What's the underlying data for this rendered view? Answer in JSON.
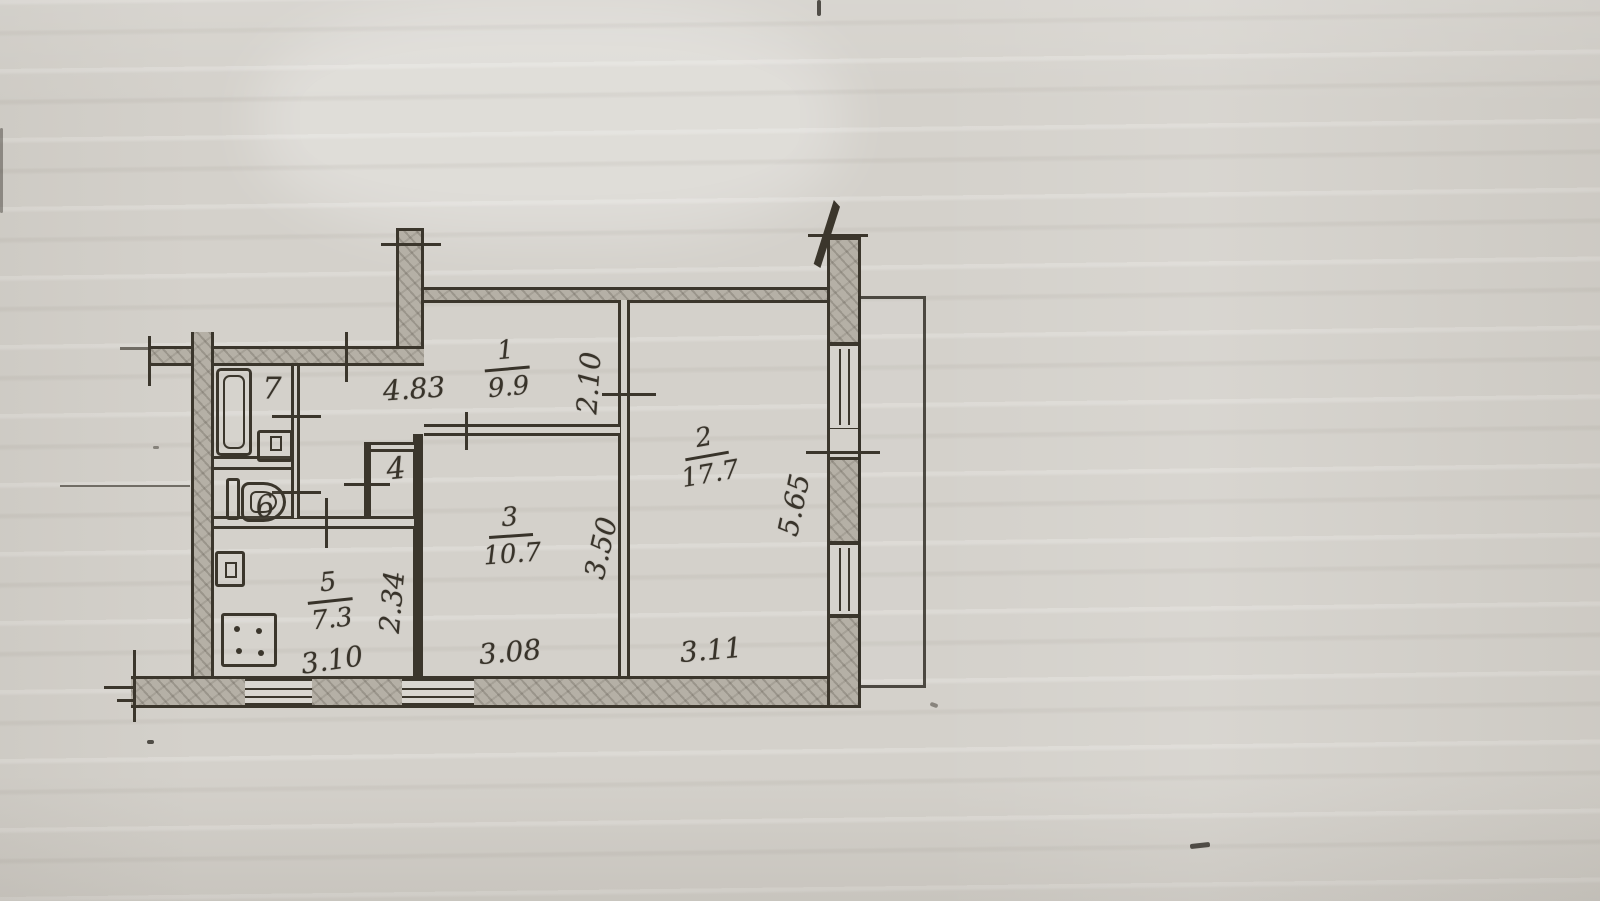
{
  "document": {
    "type": "scanned apartment floor plan (BTI technical sketch)",
    "colors": {
      "paper": "#d4d1cb",
      "ink": "#3b362c",
      "wall_fill": "#b5b0a6"
    }
  },
  "rooms": {
    "r1": {
      "number": "1",
      "area": "9.9"
    },
    "r2": {
      "number": "2",
      "area": "17.7"
    },
    "r3": {
      "number": "3",
      "area": "10.7"
    },
    "r4": {
      "number": "4"
    },
    "r5": {
      "number": "5",
      "area": "7.3"
    },
    "r6": {
      "number": "6"
    },
    "r7": {
      "number": "7"
    }
  },
  "dims": {
    "hall_length": "4.83",
    "room1_depth": "2.10",
    "room2_depth": "5.65",
    "room2_width": "3.11",
    "room3_depth": "3.50",
    "room3_width": "3.08",
    "kitchen_depth": "2.34",
    "kitchen_width": "3.10"
  }
}
